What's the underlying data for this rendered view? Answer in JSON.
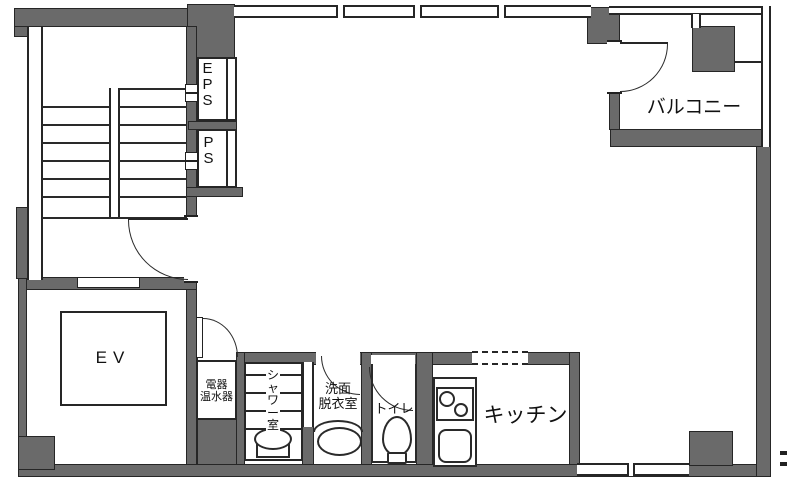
{
  "title": "apartment-floor-plan",
  "colors": {
    "wall": "#6a6a6a",
    "outline": "#262626",
    "background": "#ffffff"
  },
  "rooms": {
    "eps": "EPS",
    "ps": "PS",
    "balcony": "バルコニー",
    "elevator": "EV",
    "water_heater": "電器\n温水器",
    "shower": "シャワー室",
    "washroom": "洗面\n脱衣室",
    "toilet": "トイレ",
    "kitchen": "キッチン"
  }
}
